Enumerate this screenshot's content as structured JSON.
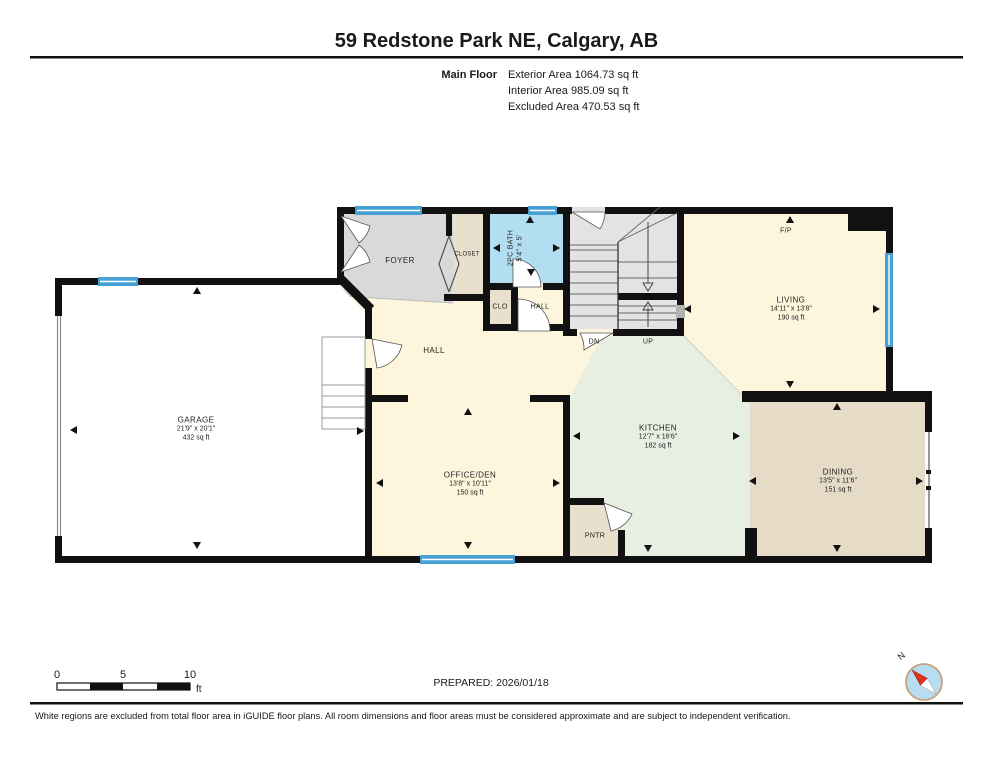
{
  "header": {
    "title": "59 Redstone Park NE, Calgary, AB",
    "floor_label": "Main Floor",
    "stats": [
      "Exterior Area 1064.73 sq ft",
      "Interior Area 985.09 sq ft",
      "Excluded Area 470.53 sq ft"
    ]
  },
  "rooms": {
    "garage": {
      "name": "GARAGE",
      "dims": "21'9\" x 20'1\"",
      "area": "432 sq ft"
    },
    "foyer": {
      "name": "FOYER"
    },
    "closet": {
      "name": "CLOSET"
    },
    "bath": {
      "name": "2PC BATH",
      "dims": "5'4\" x 5'"
    },
    "clo": {
      "name": "CLO"
    },
    "hall_small": {
      "name": "HALL"
    },
    "hall": {
      "name": "HALL"
    },
    "living": {
      "name": "LIVING",
      "dims": "14'11\" x 13'8\"",
      "area": "190 sq ft"
    },
    "kitchen": {
      "name": "KITCHEN",
      "dims": "12'7\" x 16'6\"",
      "area": "182 sq ft"
    },
    "office": {
      "name": "OFFICE/DEN",
      "dims": "13'8\" x 10'11\"",
      "area": "150 sq ft"
    },
    "pantry": {
      "name": "PNTR"
    },
    "dining": {
      "name": "DINING",
      "dims": "13'5\" x 11'6\"",
      "area": "151 sq ft"
    }
  },
  "labels": {
    "fireplace": "F/P",
    "stairs_down": "DN",
    "stairs_up": "UP"
  },
  "scale_bar": {
    "zero": "0",
    "five": "5",
    "ten": "10",
    "unit": "ft"
  },
  "prepared": "PREPARED: 2026/01/18",
  "compass": {
    "north_label": "N"
  },
  "footer": "White regions are excluded from total floor area in iGUIDE floor plans. All room dimensions and floor areas must be considered approximate and are subject to independent verification.",
  "colors": {
    "wall": "#111111",
    "window_blue": "#47a1d5",
    "living_cream": "#fdf5dc",
    "kitchen_mint": "#e7eee2",
    "closet_tan": "#e8dfcc",
    "dining_tan": "#e5dbc6",
    "foyer_gray": "#d9d9d9",
    "bath_blue": "#b3ddf1",
    "compass_red": "#e03020"
  }
}
